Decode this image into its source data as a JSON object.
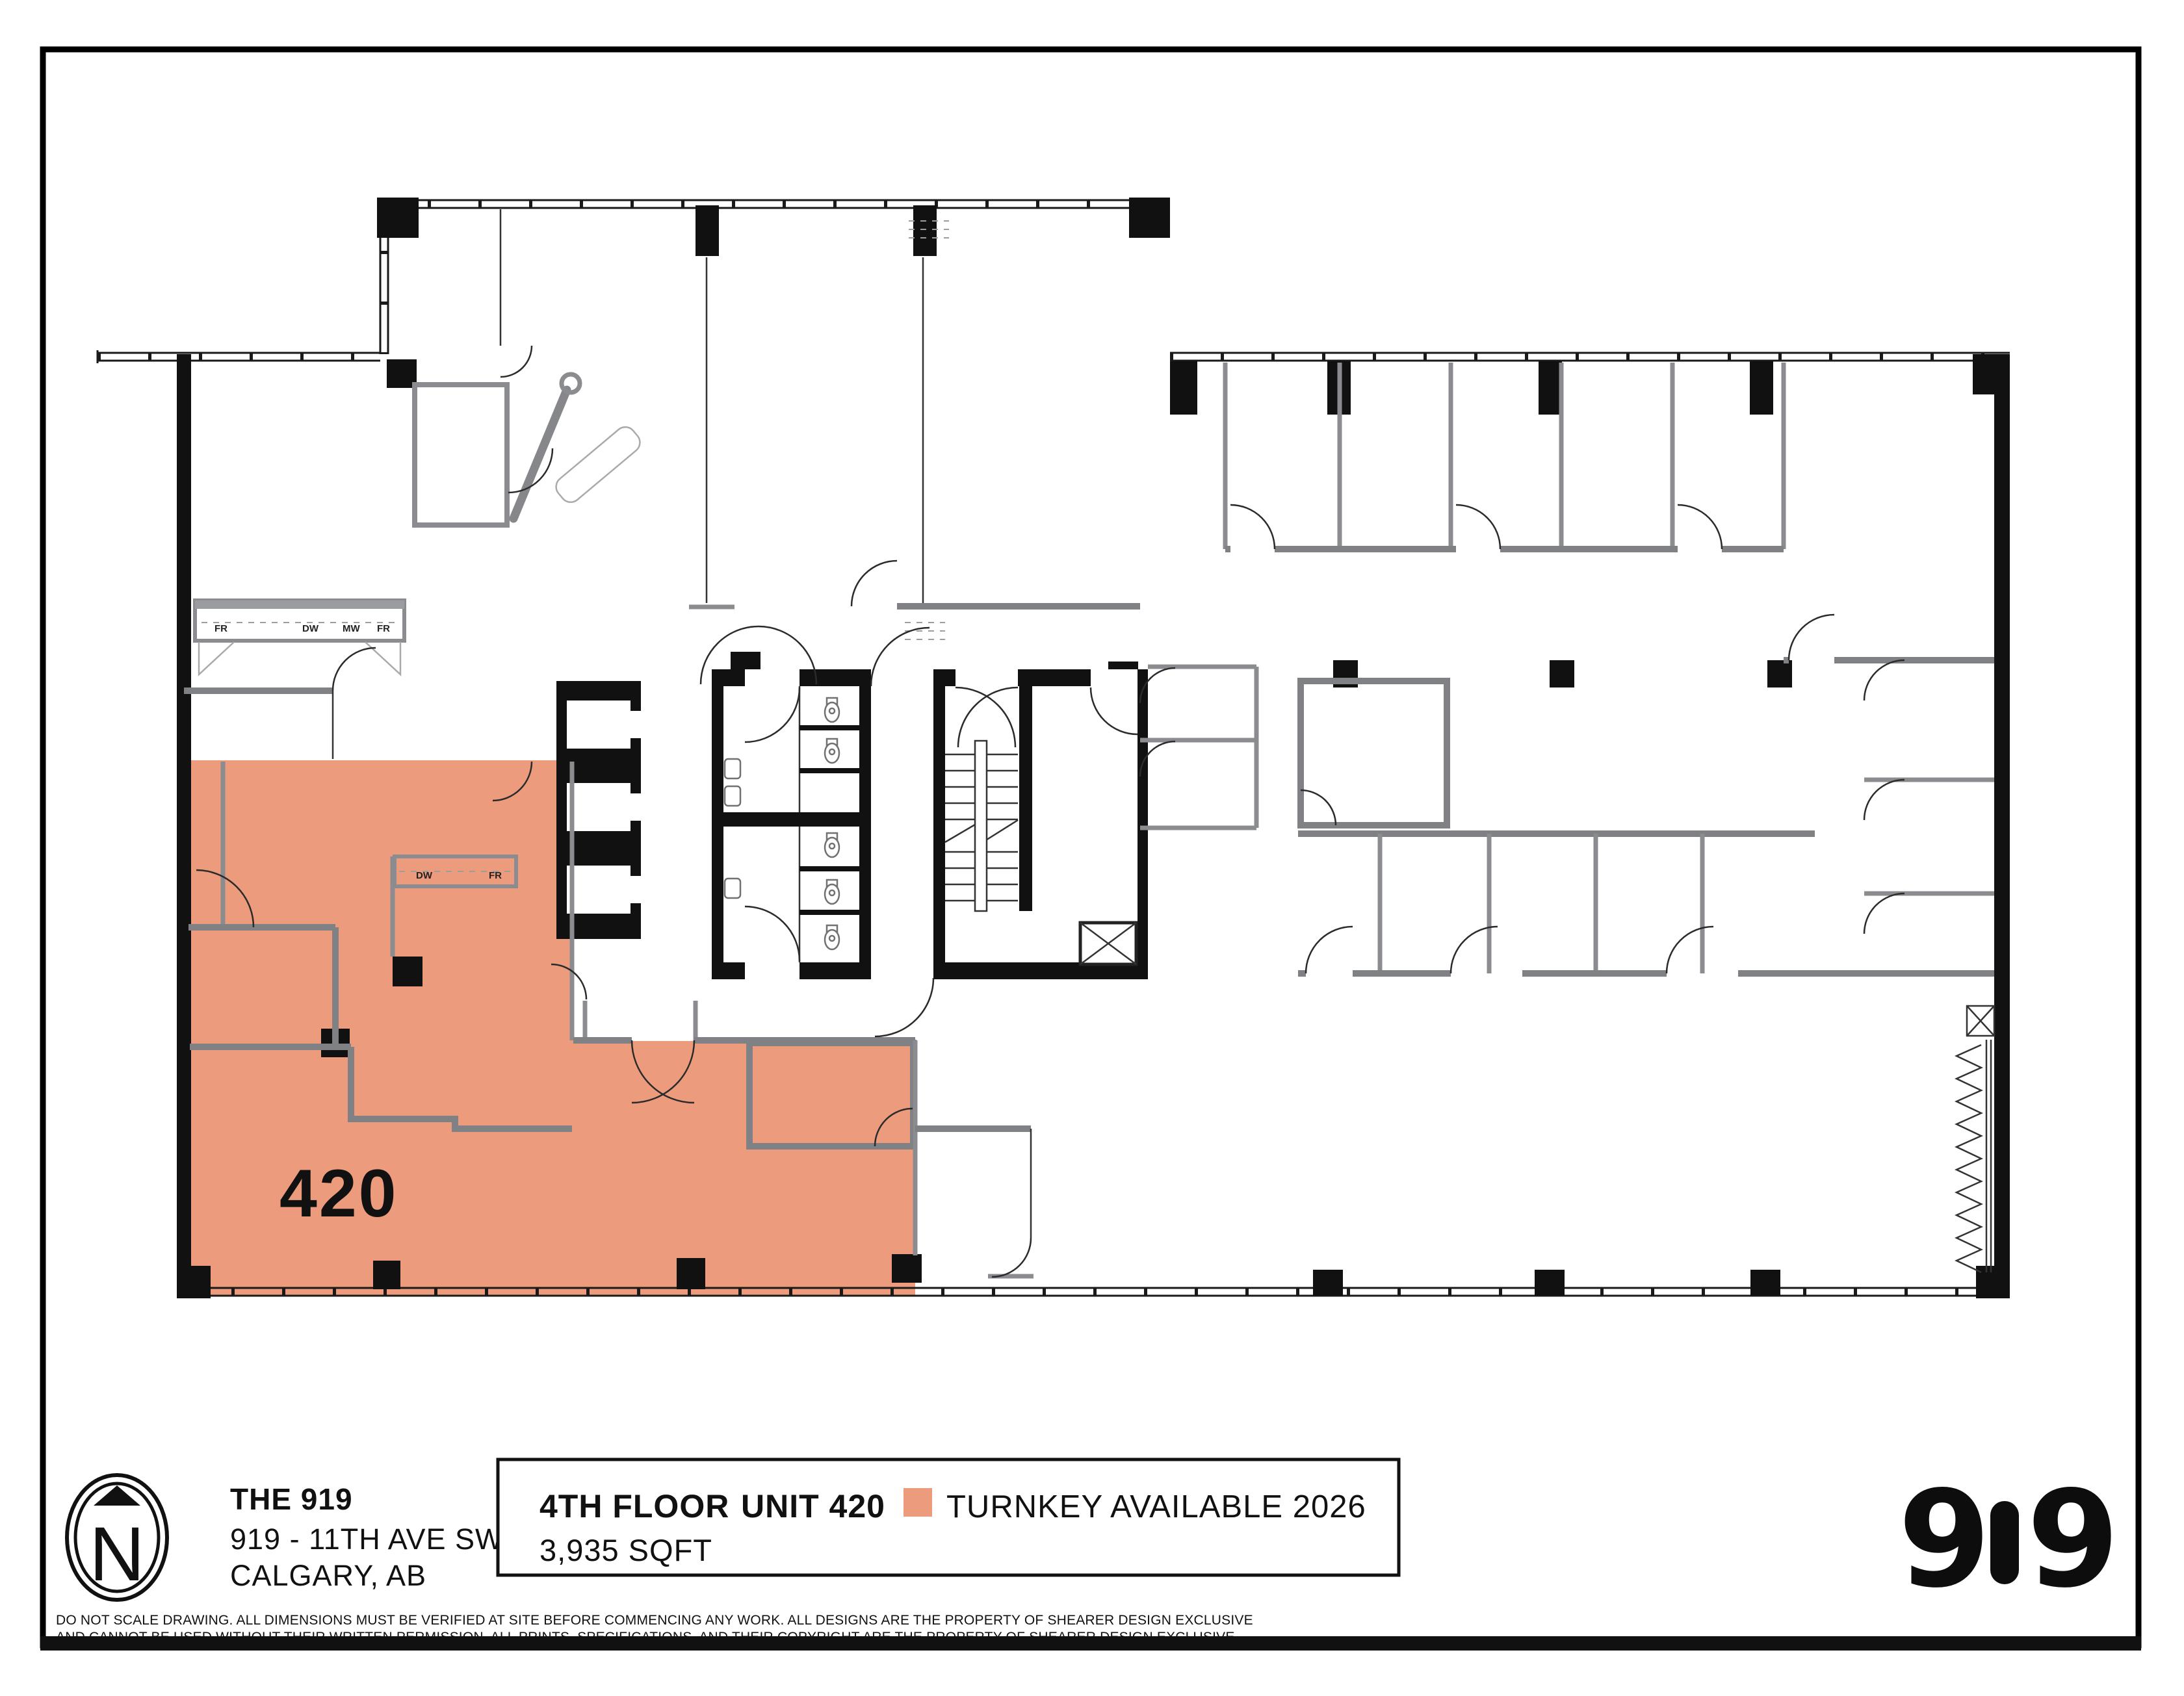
{
  "plan": {
    "unit_number": "420",
    "highlight_color": "#EC9C7C",
    "kitchen_labels": [
      "FR",
      "DW",
      "MW",
      "FR"
    ],
    "kitchenette_labels": [
      "DW",
      "FR"
    ]
  },
  "footer": {
    "north_letter": "N",
    "building": {
      "name": "THE 919",
      "address_line1": "919 - 11TH AVE SW",
      "address_line2": "CALGARY, AB"
    },
    "info_box": {
      "floor": "4TH FLOOR",
      "unit": "UNIT 420",
      "area": "3,935 SQFT",
      "legend": {
        "swatch_color": "#EC9C7C",
        "label": "TURNKEY AVAILABLE 2026"
      }
    },
    "logo": {
      "digit_left": "9",
      "digit_right": "9"
    }
  },
  "disclaimer": {
    "line1": "DO NOT SCALE DRAWING.  ALL DIMENSIONS MUST BE VERIFIED AT SITE BEFORE COMMENCING ANY WORK. ALL DESIGNS ARE THE PROPERTY OF SHEARER DESIGN EXCLUSIVE",
    "line2": "AND CANNOT BE USED WITHOUT THEIR WRITTEN PERMISSION.  ALL PRINTS, SPECIFICATIONS, AND THEIR COPYRIGHT ARE THE PROPERTY OF SHEARER DESIGN EXCLUSIVE."
  }
}
